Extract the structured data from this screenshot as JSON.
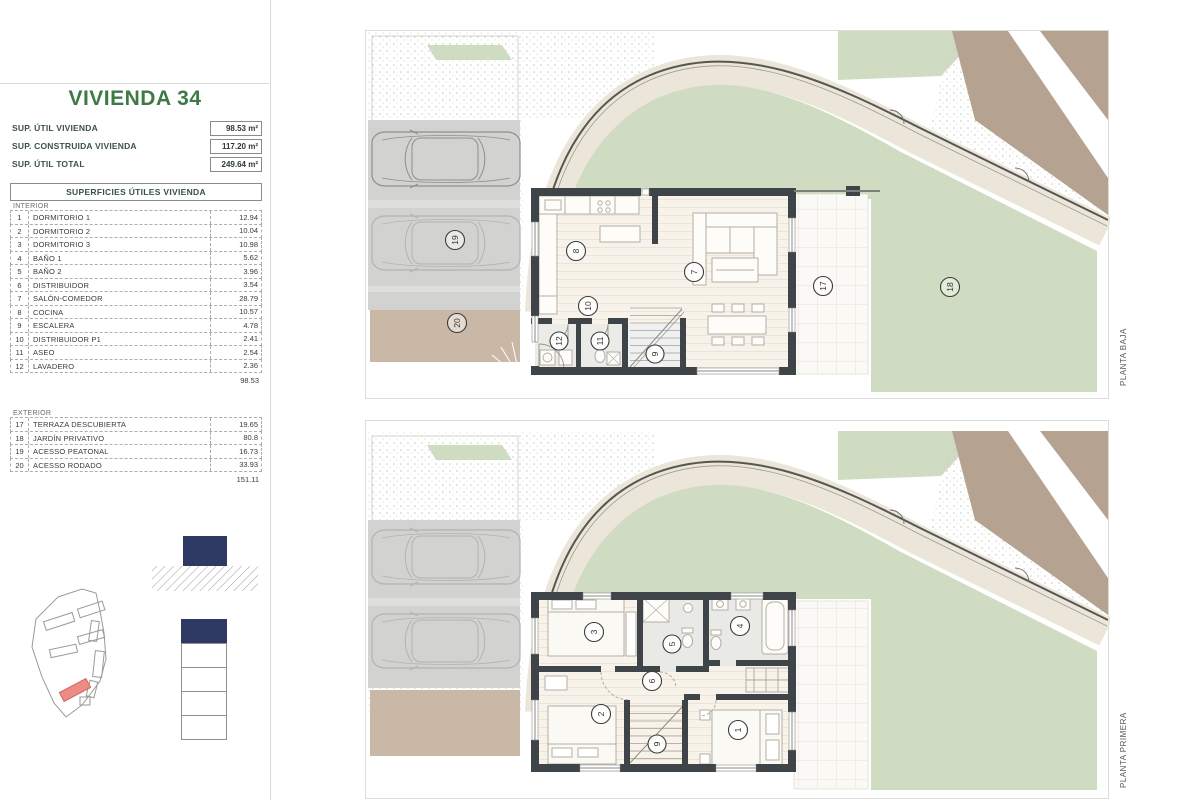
{
  "sidebar": {
    "title": "VIVIENDA 34",
    "summary": [
      {
        "label": "SUP. ÚTIL VIVIENDA",
        "value": "98.53 m²"
      },
      {
        "label": "SUP. CONSTRUIDA VIVIENDA",
        "value": "117.20 m²"
      },
      {
        "label": "SUP. ÚTIL TOTAL",
        "value": "249.64 m²"
      }
    ],
    "table": {
      "header": "SUPERFICIES ÚTILES VIVIENDA",
      "interior_label": "INTERIOR",
      "interior": [
        {
          "num": "1",
          "name": "DORMITORIO 1",
          "value": "12.94"
        },
        {
          "num": "2",
          "name": "DORMITORIO 2",
          "value": "10.04"
        },
        {
          "num": "3",
          "name": "DORMITORIO 3",
          "value": "10.98"
        },
        {
          "num": "4",
          "name": "BAÑO 1",
          "value": "5.62"
        },
        {
          "num": "5",
          "name": "BAÑO 2",
          "value": "3.96"
        },
        {
          "num": "6",
          "name": "DISTRIBUIDOR",
          "value": "3.54"
        },
        {
          "num": "7",
          "name": "SALÓN-COMEDOR",
          "value": "28.79"
        },
        {
          "num": "8",
          "name": "COCINA",
          "value": "10.57"
        },
        {
          "num": "9",
          "name": "ESCALERA",
          "value": "4.78"
        },
        {
          "num": "10",
          "name": "DISTRIBUIDOR P1",
          "value": "2.41"
        },
        {
          "num": "11",
          "name": "ASEO",
          "value": "2.54"
        },
        {
          "num": "12",
          "name": "LAVADERO",
          "value": "2.36"
        }
      ],
      "interior_total": "98.53",
      "exterior_label": "EXTERIOR",
      "exterior": [
        {
          "num": "17",
          "name": "TERRAZA DESCUBIERTA",
          "value": "19.65"
        },
        {
          "num": "18",
          "name": "JARDÍN PRIVATIVO",
          "value": "80.8"
        },
        {
          "num": "19",
          "name": "ACESSO PEATONAL",
          "value": "16.73"
        },
        {
          "num": "20",
          "name": "ACESSO RODADO",
          "value": "33.93"
        }
      ],
      "exterior_total": "151.11"
    }
  },
  "plans": {
    "baja": {
      "label": "PLANTA BAJA",
      "circles": {
        "cocina": "8",
        "salon": "7",
        "distribuidor": "10",
        "lavadero": "12",
        "aseo": "11",
        "escalera": "9",
        "terraza": "17",
        "jardin": "18",
        "peatonal": "19",
        "rodado": "20"
      }
    },
    "primera": {
      "label": "PLANTA PRIMERA",
      "circles": {
        "dorm1": "1",
        "dorm2": "2",
        "dorm3": "3",
        "bano1": "4",
        "bano2": "5",
        "distribuidor": "6",
        "escalera": "9"
      }
    }
  },
  "colors": {
    "accent_green": "#3e7a46",
    "key_navy": "#2e3a63",
    "highlight_red": "#ee8b84",
    "garden_green": "#cfdcc2",
    "driveway_tan": "#c9b8a6",
    "wall_dark": "#3f4449"
  }
}
